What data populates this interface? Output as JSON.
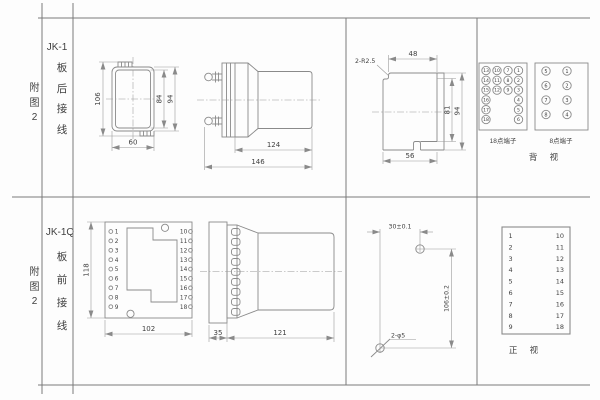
{
  "colors": {
    "line": "#8a8a8a",
    "table_line": "#7a7a7a",
    "text": "#3f3f3f",
    "background": "#fdfdfd"
  },
  "top": {
    "fig_label": "附图2",
    "model": "JK-1",
    "wiring": "板后接线",
    "rear_view": {
      "dim_total_h": "106",
      "dim_inner_h": "84",
      "dim_outer_h": "94",
      "dim_width": "60"
    },
    "side_view": {
      "dim_body": "124",
      "dim_total": "146"
    },
    "cutout_view": {
      "radius_note": "2-R2.5",
      "dim_top": "48",
      "dim_inner_h": "81",
      "dim_outer_h": "94",
      "dim_bottom": "56"
    },
    "terminal_panel": {
      "block18": {
        "label": "18点端子",
        "r1": [
          "13",
          "10",
          "7",
          "1"
        ],
        "r2": [
          "14",
          "11",
          "8",
          "2"
        ],
        "r3": [
          "15",
          "12",
          "9",
          "3"
        ],
        "r4": [
          "16",
          "4"
        ],
        "r5": [
          "17",
          "5"
        ],
        "r6": [
          "18",
          "6"
        ]
      },
      "block8": {
        "label": "8点端子",
        "r1": [
          "5",
          "1"
        ],
        "r2": [
          "6",
          "2"
        ],
        "r3": [
          "7",
          "3"
        ],
        "r4": [
          "8",
          "4"
        ]
      },
      "view_label": "背 视"
    }
  },
  "bottom": {
    "fig_label": "附图2",
    "model": "JK-1Q",
    "wiring": "板前接线",
    "front_view": {
      "dim_height": "118",
      "dim_width": "102",
      "left_terminals": [
        "1",
        "2",
        "3",
        "4",
        "5",
        "6",
        "7",
        "8",
        "9"
      ],
      "right_terminals": [
        "10",
        "11",
        "12",
        "13",
        "14",
        "15",
        "16",
        "17",
        "18"
      ]
    },
    "side_view": {
      "dim_plate": "35",
      "dim_body": "121"
    },
    "drill_view": {
      "dim_spacing_h": "30±0.1",
      "dim_spacing_v": "106±0.2",
      "hole_note": "2-φ5"
    },
    "terminal_panel": {
      "left": [
        "1",
        "2",
        "3",
        "4",
        "5",
        "6",
        "7",
        "8",
        "9"
      ],
      "right": [
        "10",
        "11",
        "12",
        "13",
        "14",
        "15",
        "16",
        "17",
        "18"
      ],
      "view_label": "正 视"
    }
  }
}
